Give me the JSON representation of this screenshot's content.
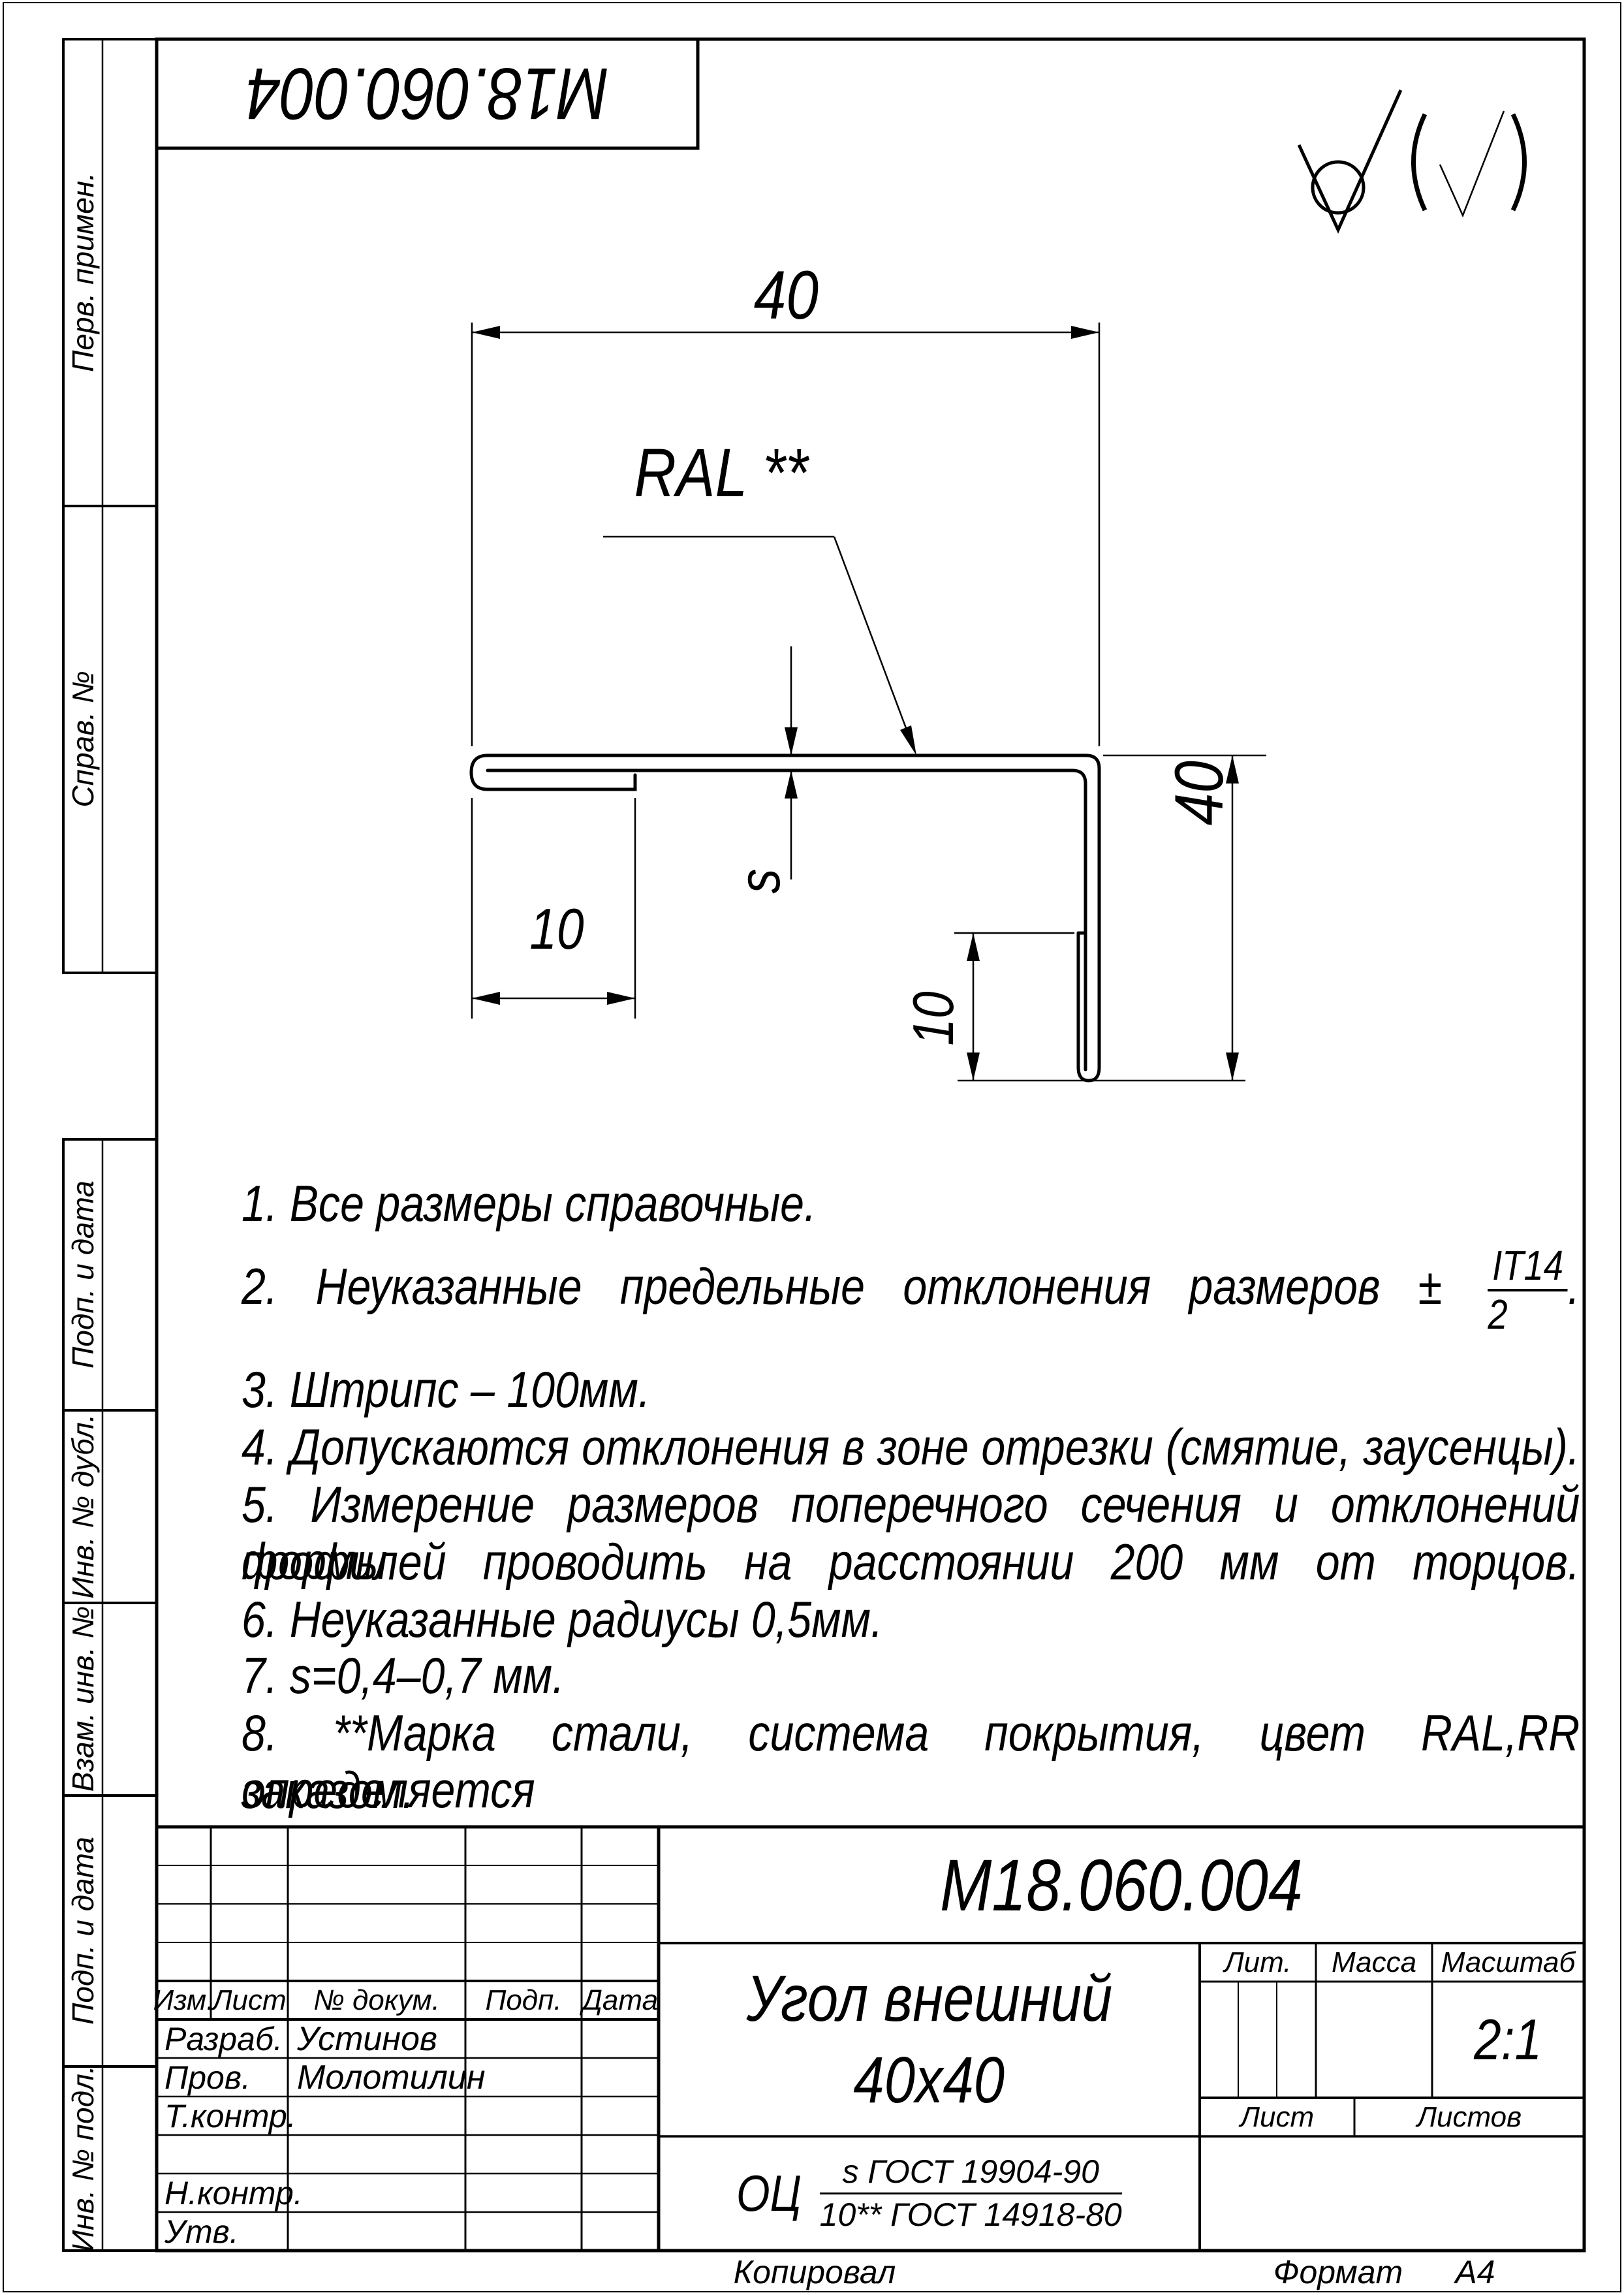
{
  "sheet": {
    "copied_label": "Копировал",
    "format_label": "Формат",
    "format_value": "А4"
  },
  "stamp_top": {
    "designation": "М18.060.004"
  },
  "margin_stamps": [
    "Перв. примен.",
    "Справ. №",
    "Подп. и дата",
    "Инв. № дубл.",
    "Взам. инв. №",
    "Подп. и дата",
    "Инв. № подл."
  ],
  "surface_finish": {
    "main_symbol": "machining-not-required-check-with-circle",
    "bracket_note": "(√)"
  },
  "drawing": {
    "coating_label": "RAL **",
    "dims": {
      "top_width": "40",
      "left_hem": "10",
      "thickness": "s",
      "right_height": "40",
      "bottom_hem": "10"
    }
  },
  "notes": {
    "n1": "1.  Все размеры справочные.",
    "n2_text": "2.  Неуказанные предельные отклонения размеров ±",
    "n2_frac_num": "IT14",
    "n2_frac_den": "2",
    "n2_period": ".",
    "n3": "3.  Штрипс – 100мм.",
    "n4": "4.  Допускаются отклонения в зоне отрезки (смятие, заусенцы).",
    "n5a": "5.  Измерение размеров поперечного сечения и отклонений формы",
    "n5b": "профилей проводить на расстоянии 200 мм от торцов.",
    "n6": "6.  Неуказанные радиусы 0,5мм.",
    "n7": "7.  s=0,4–0,7 мм.",
    "n8a": "8.  **Марка стали, система покрытия, цвет RAL,RR определяется",
    "n8b": "заказом."
  },
  "title_block": {
    "designation": "М18.060.004",
    "name_line1": "Угол внешний",
    "name_line2": "40х40",
    "cols": {
      "izm": "Изм.",
      "list": "Лист",
      "doc": "№ докум.",
      "podp": "Подп.",
      "data": "Дата"
    },
    "rows": {
      "razrab": "Разраб.",
      "prov": "Пров.",
      "tkontr": "Т.контр.",
      "nkontr": "Н.контр.",
      "utv": "Утв."
    },
    "names": {
      "razrab": "Устинов",
      "prov": "Молотилин"
    },
    "lit_label": "Лит.",
    "mass_label": "Масса",
    "scale_label": "Масштаб",
    "scale_value": "2:1",
    "sheet_label": "Лист",
    "sheets_label": "Листов",
    "material": {
      "prefix": "ОЦ",
      "num": "s ГОСТ 19904-90",
      "den": "10** ГОСТ 14918-80"
    }
  }
}
